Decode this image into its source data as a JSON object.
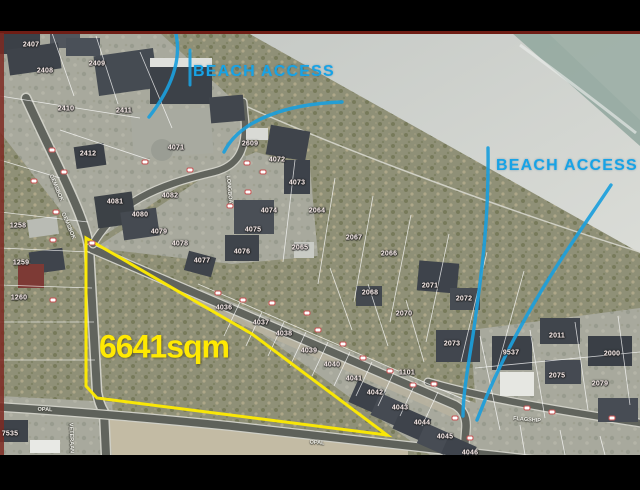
{
  "annotations": {
    "area_label": "6641sqm",
    "beach_access_1": "BEACH ACCESS",
    "beach_access_2": "BEACH ACCESS"
  },
  "colors": {
    "area_outline": "#ffec00",
    "area_text": "#ffe902",
    "beach_access_text": "#17a3e6",
    "access_path_line": "#1c9fdc",
    "map_border": "#6f1d15",
    "frame": "#000000"
  },
  "map": {
    "plot_labels": [
      {
        "t": "2407",
        "x": 31,
        "y": 45
      },
      {
        "t": "2408",
        "x": 45,
        "y": 71
      },
      {
        "t": "2409",
        "x": 97,
        "y": 64
      },
      {
        "t": "2410",
        "x": 66,
        "y": 109
      },
      {
        "t": "2411",
        "x": 124,
        "y": 111
      },
      {
        "t": "2412",
        "x": 88,
        "y": 154
      },
      {
        "t": "4071",
        "x": 176,
        "y": 148
      },
      {
        "t": "2609",
        "x": 250,
        "y": 144
      },
      {
        "t": "4072",
        "x": 277,
        "y": 160
      },
      {
        "t": "4073",
        "x": 297,
        "y": 183
      },
      {
        "t": "4074",
        "x": 269,
        "y": 211
      },
      {
        "t": "4075",
        "x": 253,
        "y": 230
      },
      {
        "t": "4076",
        "x": 242,
        "y": 252
      },
      {
        "t": "4077",
        "x": 202,
        "y": 261
      },
      {
        "t": "4078",
        "x": 180,
        "y": 244
      },
      {
        "t": "4079",
        "x": 159,
        "y": 232
      },
      {
        "t": "4080",
        "x": 140,
        "y": 215
      },
      {
        "t": "4081",
        "x": 115,
        "y": 202
      },
      {
        "t": "4082",
        "x": 170,
        "y": 196
      },
      {
        "t": "2064",
        "x": 317,
        "y": 211
      },
      {
        "t": "2065",
        "x": 300,
        "y": 248
      },
      {
        "t": "2066",
        "x": 389,
        "y": 254
      },
      {
        "t": "2067",
        "x": 354,
        "y": 238
      },
      {
        "t": "2068",
        "x": 370,
        "y": 293
      },
      {
        "t": "2070",
        "x": 404,
        "y": 314
      },
      {
        "t": "2071",
        "x": 430,
        "y": 286
      },
      {
        "t": "2072",
        "x": 464,
        "y": 299
      },
      {
        "t": "2073",
        "x": 452,
        "y": 344
      },
      {
        "t": "9537",
        "x": 511,
        "y": 353
      },
      {
        "t": "2011",
        "x": 557,
        "y": 336
      },
      {
        "t": "2000",
        "x": 612,
        "y": 354
      },
      {
        "t": "2075",
        "x": 557,
        "y": 376
      },
      {
        "t": "2079",
        "x": 600,
        "y": 384
      },
      {
        "t": "1101",
        "x": 407,
        "y": 373
      },
      {
        "t": "4036",
        "x": 224,
        "y": 308
      },
      {
        "t": "4037",
        "x": 261,
        "y": 323
      },
      {
        "t": "4038",
        "x": 284,
        "y": 334
      },
      {
        "t": "4039",
        "x": 309,
        "y": 351
      },
      {
        "t": "4040",
        "x": 332,
        "y": 365
      },
      {
        "t": "4041",
        "x": 354,
        "y": 379
      },
      {
        "t": "4042",
        "x": 375,
        "y": 393
      },
      {
        "t": "4043",
        "x": 400,
        "y": 408
      },
      {
        "t": "4044",
        "x": 422,
        "y": 423
      },
      {
        "t": "4045",
        "x": 445,
        "y": 437
      },
      {
        "t": "4046",
        "x": 470,
        "y": 453
      },
      {
        "t": "1258",
        "x": 18,
        "y": 226
      },
      {
        "t": "1259",
        "x": 21,
        "y": 263
      },
      {
        "t": "1260",
        "x": 19,
        "y": 298
      },
      {
        "t": "7535",
        "x": 10,
        "y": 434
      }
    ],
    "road_labels": [
      {
        "t": "OPAL",
        "x": 45,
        "y": 410,
        "r": 2
      },
      {
        "t": "OPAL",
        "x": 317,
        "y": 443,
        "r": 4
      },
      {
        "t": "FLAGSHIP",
        "x": 527,
        "y": 420,
        "r": 5
      },
      {
        "t": "GEMSBOK",
        "x": 56,
        "y": 188,
        "r": 67
      },
      {
        "t": "GEMSBOK",
        "x": 68,
        "y": 226,
        "r": 67
      },
      {
        "t": "LONGBOAT",
        "x": 229,
        "y": 191,
        "r": 85
      },
      {
        "t": "VETERAAN",
        "x": 71,
        "y": 438,
        "r": 88
      }
    ],
    "stand_markers": [
      [
        52,
        150
      ],
      [
        34,
        181
      ],
      [
        64,
        172
      ],
      [
        56,
        212
      ],
      [
        53,
        240
      ],
      [
        53,
        300
      ],
      [
        92,
        243
      ],
      [
        145,
        162
      ],
      [
        190,
        170
      ],
      [
        247,
        163
      ],
      [
        263,
        172
      ],
      [
        248,
        192
      ],
      [
        230,
        206
      ],
      [
        218,
        293
      ],
      [
        243,
        300
      ],
      [
        272,
        303
      ],
      [
        307,
        313
      ],
      [
        318,
        330
      ],
      [
        343,
        344
      ],
      [
        363,
        358
      ],
      [
        390,
        371
      ],
      [
        413,
        385
      ],
      [
        434,
        384
      ],
      [
        455,
        418
      ],
      [
        470,
        438
      ],
      [
        527,
        408
      ],
      [
        552,
        412
      ],
      [
        612,
        418
      ]
    ]
  }
}
